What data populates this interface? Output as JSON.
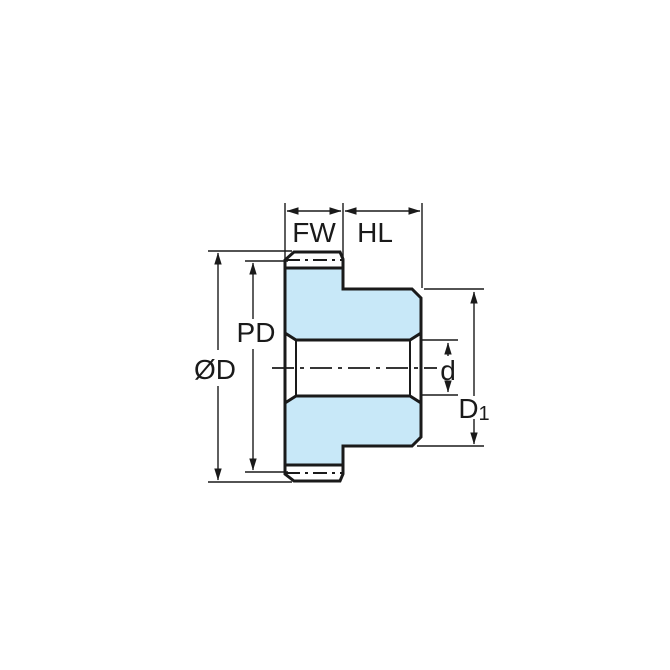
{
  "diagram": {
    "title": "spur-gear-cross-section-dimension-drawing",
    "labels": {
      "face_width": "FW",
      "hub_length": "HL",
      "pitch_diameter": "PD",
      "outside_diameter": "ØD",
      "bore_diameter": "d",
      "hub_diameter_main": "D",
      "hub_diameter_sub": "1"
    },
    "colors": {
      "body_fill": "#c8e8f8",
      "line": "#1a1a1a",
      "background": "#ffffff"
    }
  }
}
